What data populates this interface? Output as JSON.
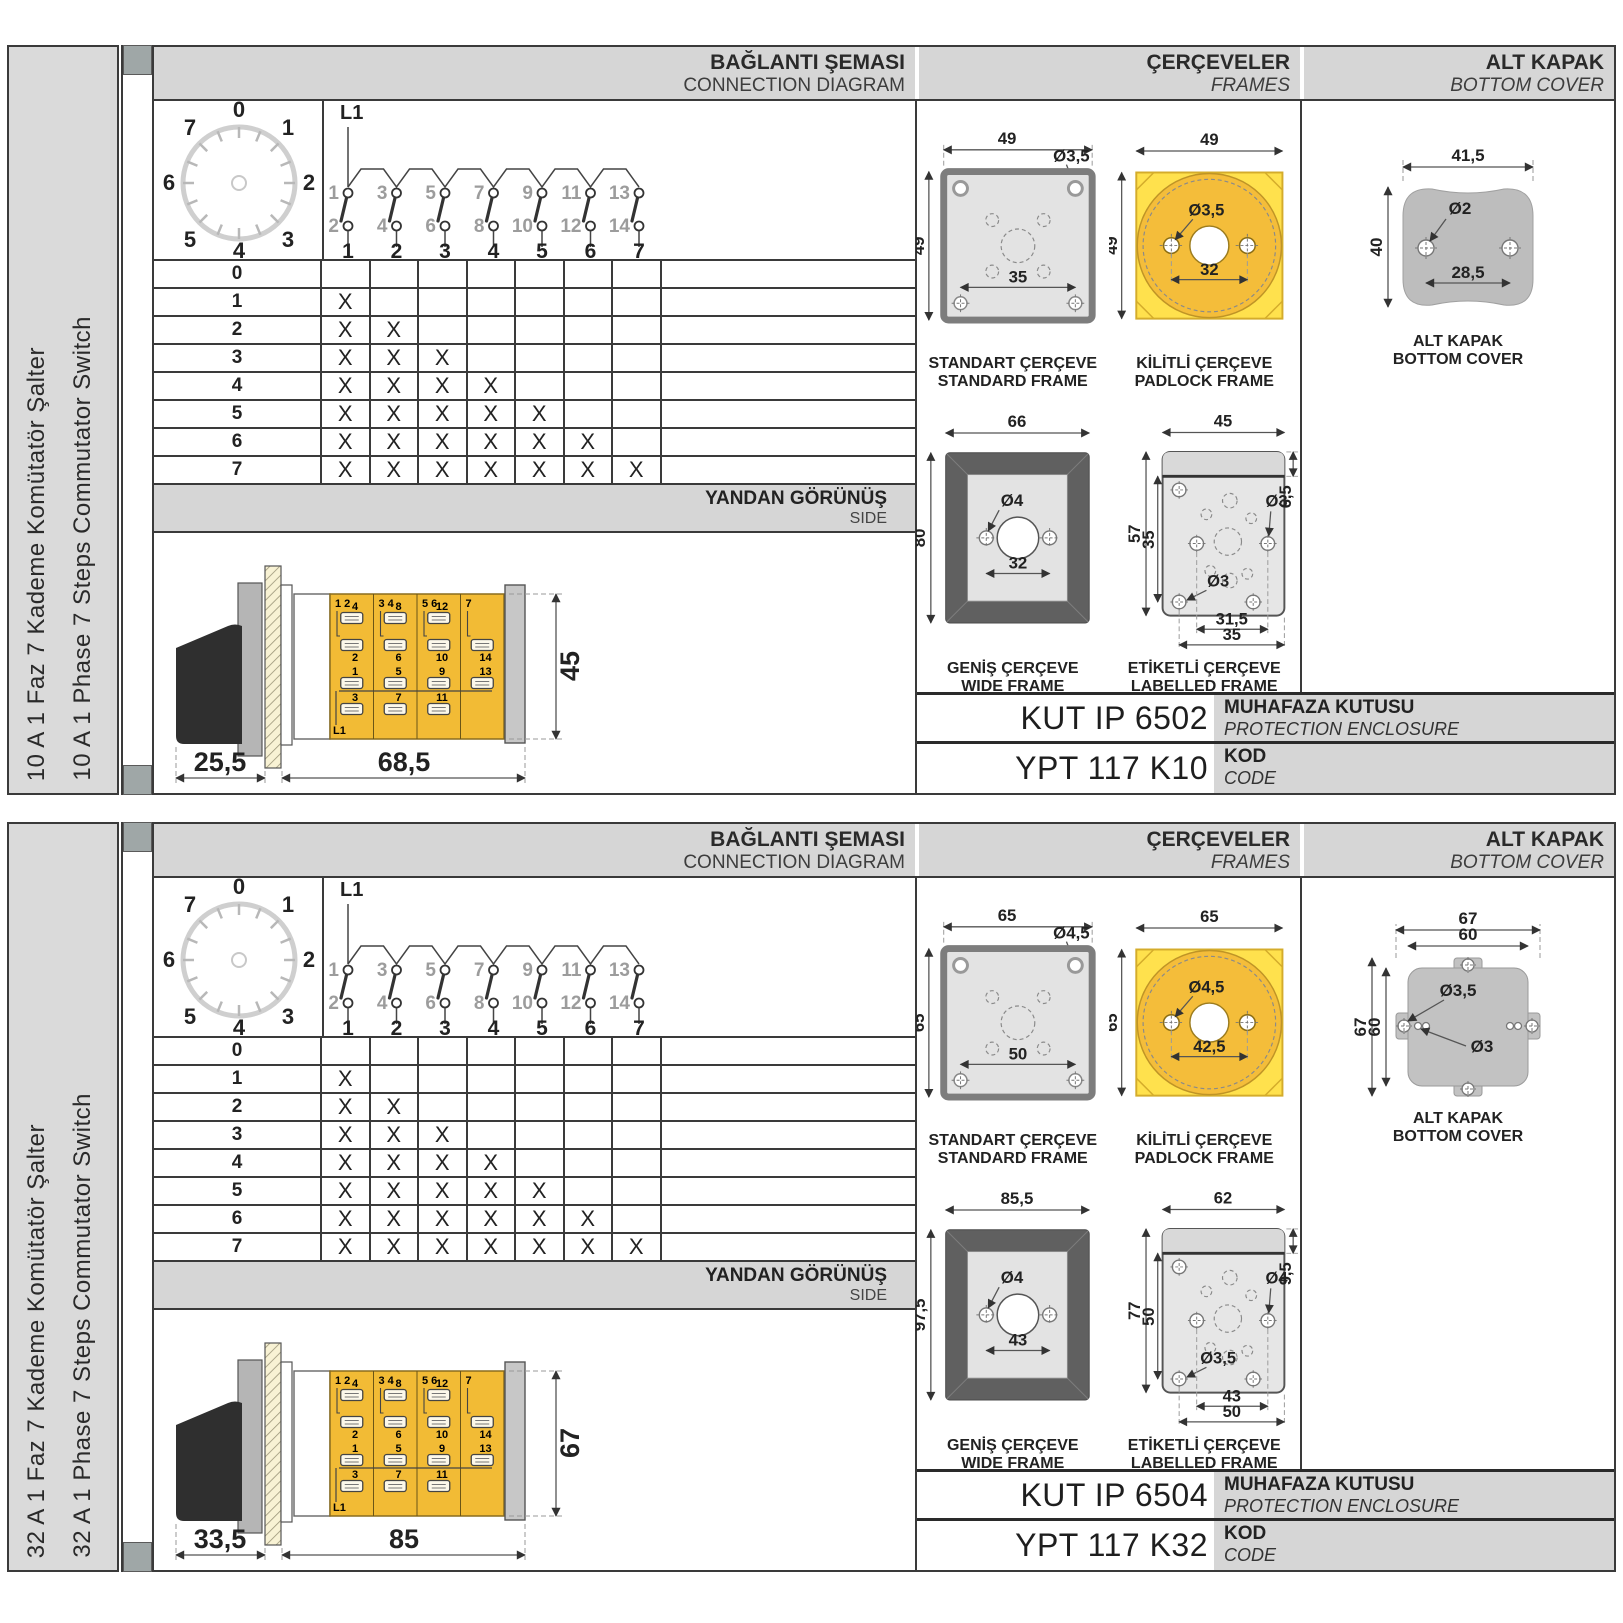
{
  "sections": [
    {
      "sidebar_tr": "10 A 1 Faz 7 Kademe Komütatör Şalter",
      "sidebar_en": "10 A 1 Phase 7 Steps Commutator Switch",
      "headers": {
        "diagram_tr": "BAĞLANTI ŞEMASI",
        "diagram_en": "CONNECTION DIAGRAM",
        "frames_tr": "ÇERÇEVELER",
        "frames_en": "FRAMES",
        "cover_tr": "ALT KAPAK",
        "cover_en": "BOTTOM COVER"
      },
      "dial": {
        "labels": [
          "0",
          "1",
          "2",
          "3",
          "4",
          "5",
          "6",
          "7"
        ]
      },
      "contacts": {
        "feed": "L1",
        "top": [
          "1",
          "3",
          "5",
          "7",
          "9",
          "11",
          "13"
        ],
        "bottom": [
          "2",
          "4",
          "6",
          "8",
          "10",
          "12",
          "14"
        ],
        "columns": [
          "1",
          "2",
          "3",
          "4",
          "5",
          "6",
          "7"
        ]
      },
      "table": {
        "rows": [
          {
            "label": "0",
            "marks": [
              "",
              "",
              "",
              "",
              "",
              "",
              ""
            ]
          },
          {
            "label": "1",
            "marks": [
              "X",
              "",
              "",
              "",
              "",
              "",
              ""
            ]
          },
          {
            "label": "2",
            "marks": [
              "X",
              "X",
              "",
              "",
              "",
              "",
              ""
            ]
          },
          {
            "label": "3",
            "marks": [
              "X",
              "X",
              "X",
              "",
              "",
              "",
              ""
            ]
          },
          {
            "label": "4",
            "marks": [
              "X",
              "X",
              "X",
              "X",
              "",
              "",
              ""
            ]
          },
          {
            "label": "5",
            "marks": [
              "X",
              "X",
              "X",
              "X",
              "X",
              "",
              ""
            ]
          },
          {
            "label": "6",
            "marks": [
              "X",
              "X",
              "X",
              "X",
              "X",
              "X",
              ""
            ]
          },
          {
            "label": "7",
            "marks": [
              "X",
              "X",
              "X",
              "X",
              "X",
              "X",
              "X"
            ]
          }
        ]
      },
      "side": {
        "title_tr": "YANDAN GÖRÜNÜŞ",
        "title_en": "SIDE",
        "dim_front": "25,5",
        "dim_body": "68,5",
        "dim_height": "45",
        "feed": "L1",
        "segments": [
          {
            "head": "1  2",
            "t1": "4",
            "t2": "2",
            "b1": "1",
            "b2": "3"
          },
          {
            "head": "3  4",
            "t1": "8",
            "t2": "6",
            "b1": "5",
            "b2": "7"
          },
          {
            "head": "5  6",
            "t1": "12",
            "t2": "10",
            "b1": "9",
            "b2": "11"
          },
          {
            "head": "7",
            "t1": "",
            "t2": "14",
            "b1": "13",
            "b2": ""
          }
        ]
      },
      "frames": {
        "standard": {
          "name_tr": "STANDART ÇERÇEVE",
          "name_en": "STANDARD FRAME",
          "w": "49",
          "h": "49",
          "inner": "35",
          "hole": "Ø3,5"
        },
        "padlock": {
          "name_tr": "KİLİTLİ ÇERÇEVE",
          "name_en": "PADLOCK FRAME",
          "w": "49",
          "h": "49",
          "inner": "32",
          "hole": "Ø3,5"
        },
        "wide": {
          "name_tr": "GENİŞ ÇERÇEVE",
          "name_en": "WIDE FRAME",
          "w": "66",
          "h": "80",
          "inner": "32",
          "hole": "Ø4"
        },
        "labelled": {
          "name_tr": "ETİKETLİ ÇERÇEVE",
          "name_en": "LABELLED FRAME",
          "w": "45",
          "h": "57",
          "inner_h": "35",
          "strip": "6,5",
          "hole_a": "Ø3",
          "hole_b": "Ø3",
          "dim_a": "31,5",
          "dim_b": "35"
        }
      },
      "cover": {
        "variant": "blob",
        "caption_tr": "ALT KAPAK",
        "caption_en": "BOTTOM COVER",
        "blob": {
          "w": "41,5",
          "h": "40",
          "inner": "28,5",
          "hole": "Ø2"
        },
        "tabs": {
          "w1": "",
          "w2": "",
          "h1": "",
          "h2": "",
          "hole_a": "",
          "hole_b": ""
        }
      },
      "codes": {
        "enclosure_value": "KUT IP 6502",
        "enclosure_tr": "MUHAFAZA KUTUSU",
        "enclosure_en": "PROTECTION ENCLOSURE",
        "code_value": "YPT 117 K10",
        "code_tr": "KOD",
        "code_en": "CODE"
      }
    },
    {
      "sidebar_tr": "32 A 1 Faz 7 Kademe Komütatör Şalter",
      "sidebar_en": "32 A 1 Phase 7 Steps Commutator Switch",
      "headers": {
        "diagram_tr": "BAĞLANTI ŞEMASI",
        "diagram_en": "CONNECTION DIAGRAM",
        "frames_tr": "ÇERÇEVELER",
        "frames_en": "FRAMES",
        "cover_tr": "ALT KAPAK",
        "cover_en": "BOTTOM COVER"
      },
      "dial": {
        "labels": [
          "0",
          "1",
          "2",
          "3",
          "4",
          "5",
          "6",
          "7"
        ]
      },
      "contacts": {
        "feed": "L1",
        "top": [
          "1",
          "3",
          "5",
          "7",
          "9",
          "11",
          "13"
        ],
        "bottom": [
          "2",
          "4",
          "6",
          "8",
          "10",
          "12",
          "14"
        ],
        "columns": [
          "1",
          "2",
          "3",
          "4",
          "5",
          "6",
          "7"
        ]
      },
      "table": {
        "rows": [
          {
            "label": "0",
            "marks": [
              "",
              "",
              "",
              "",
              "",
              "",
              ""
            ]
          },
          {
            "label": "1",
            "marks": [
              "X",
              "",
              "",
              "",
              "",
              "",
              ""
            ]
          },
          {
            "label": "2",
            "marks": [
              "X",
              "X",
              "",
              "",
              "",
              "",
              ""
            ]
          },
          {
            "label": "3",
            "marks": [
              "X",
              "X",
              "X",
              "",
              "",
              "",
              ""
            ]
          },
          {
            "label": "4",
            "marks": [
              "X",
              "X",
              "X",
              "X",
              "",
              "",
              ""
            ]
          },
          {
            "label": "5",
            "marks": [
              "X",
              "X",
              "X",
              "X",
              "X",
              "",
              ""
            ]
          },
          {
            "label": "6",
            "marks": [
              "X",
              "X",
              "X",
              "X",
              "X",
              "X",
              ""
            ]
          },
          {
            "label": "7",
            "marks": [
              "X",
              "X",
              "X",
              "X",
              "X",
              "X",
              "X"
            ]
          }
        ]
      },
      "side": {
        "title_tr": "YANDAN GÖRÜNÜŞ",
        "title_en": "SIDE",
        "dim_front": "33,5",
        "dim_body": "85",
        "dim_height": "67",
        "feed": "L1",
        "segments": [
          {
            "head": "1  2",
            "t1": "4",
            "t2": "2",
            "b1": "1",
            "b2": "3"
          },
          {
            "head": "3  4",
            "t1": "8",
            "t2": "6",
            "b1": "5",
            "b2": "7"
          },
          {
            "head": "5  6",
            "t1": "12",
            "t2": "10",
            "b1": "9",
            "b2": "11"
          },
          {
            "head": "7",
            "t1": "",
            "t2": "14",
            "b1": "13",
            "b2": ""
          }
        ]
      },
      "frames": {
        "standard": {
          "name_tr": "STANDART ÇERÇEVE",
          "name_en": "STANDARD FRAME",
          "w": "65",
          "h": "65",
          "inner": "50",
          "hole": "Ø4,5"
        },
        "padlock": {
          "name_tr": "KİLİTLİ ÇERÇEVE",
          "name_en": "PADLOCK FRAME",
          "w": "65",
          "h": "65",
          "inner": "42,5",
          "hole": "Ø4,5"
        },
        "wide": {
          "name_tr": "GENİŞ ÇERÇEVE",
          "name_en": "WIDE FRAME",
          "w": "85,5",
          "h": "97,5",
          "inner": "43",
          "hole": "Ø4"
        },
        "labelled": {
          "name_tr": "ETİKETLİ ÇERÇEVE",
          "name_en": "LABELLED FRAME",
          "w": "62",
          "h": "77",
          "inner_h": "50",
          "strip": "9,5",
          "hole_a": "Ø4",
          "hole_b": "Ø3,5",
          "dim_a": "43",
          "dim_b": "50"
        }
      },
      "cover": {
        "variant": "tabs",
        "caption_tr": "ALT KAPAK",
        "caption_en": "BOTTOM COVER",
        "blob": {
          "w": "",
          "h": "",
          "inner": "",
          "hole": ""
        },
        "tabs": {
          "w1": "67",
          "w2": "60",
          "h1": "67",
          "h2": "60",
          "hole_a": "Ø3,5",
          "hole_b": "Ø3"
        }
      },
      "codes": {
        "enclosure_value": "KUT IP 6504",
        "enclosure_tr": "MUHAFAZA KUTUSU",
        "enclosure_en": "PROTECTION ENCLOSURE",
        "code_value": "YPT 117 K32",
        "code_tr": "KOD",
        "code_en": "CODE"
      }
    }
  ]
}
